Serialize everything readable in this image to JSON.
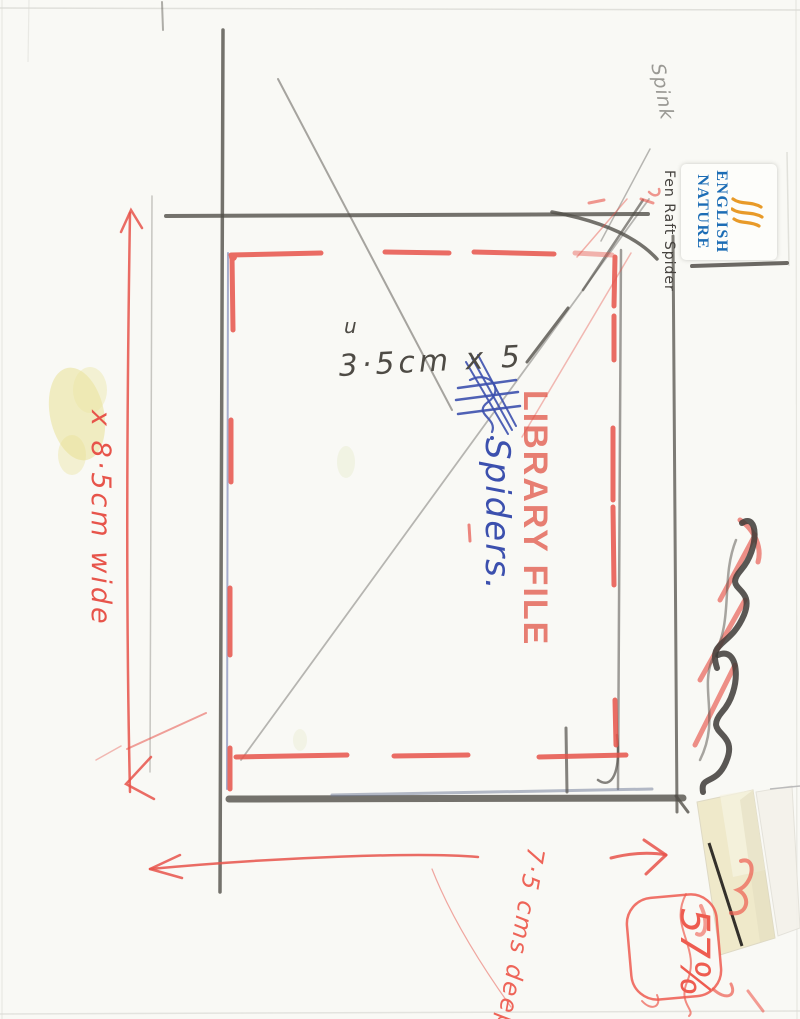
{
  "scan": {
    "stamp_label": "LIBRARY FILE",
    "sticker": {
      "line1": "ENGLISH",
      "line2": "NATURE",
      "note": "Fen Raft Spider"
    },
    "notes": {
      "corner": "Spink",
      "size": "3·5cm x 5",
      "mark": "u",
      "subject": "Spiders.",
      "width": "x 8·5cm wide",
      "depth": "7·5 cms deep.",
      "number": "57%"
    },
    "colors": {
      "pencil": "#53504a",
      "red_marker": "#e7544a",
      "blue_pen": "#3c50ae",
      "stamp_red": "#df4d40",
      "sticker_blue": "#1d6db5",
      "sticker_orange": "#e89a28",
      "stain_yellow": "#e7df8e"
    }
  }
}
